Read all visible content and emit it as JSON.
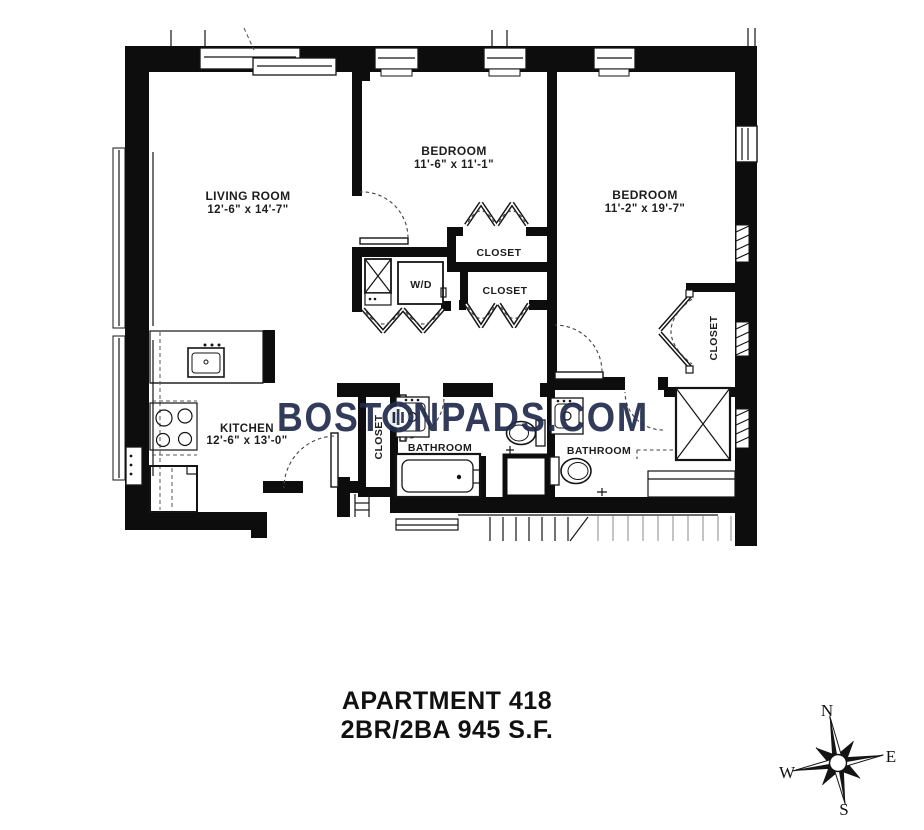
{
  "watermark": {
    "prefix": "BOST",
    "suffix": "NPADS.COM",
    "color": "#212b4c"
  },
  "rooms": {
    "living_room": {
      "name": "LIVING ROOM",
      "dims": "12'-6\" x 14'-7\""
    },
    "bedroom_1": {
      "name": "BEDROOM",
      "dims": "11'-6\" x 11'-1\""
    },
    "bedroom_2": {
      "name": "BEDROOM",
      "dims": "11'-2\" x 19'-7\""
    },
    "kitchen": {
      "name": "KITCHEN",
      "dims": "12'-6\" x 13'-0\""
    },
    "bathroom_1": {
      "name": "BATHROOM"
    },
    "bathroom_2": {
      "name": "BATHROOM"
    },
    "closet_bedroom_1_upper": {
      "name": "CLOSET"
    },
    "closet_bedroom_1_lower": {
      "name": "CLOSET"
    },
    "closet_entry": {
      "name": "CLOSET"
    },
    "closet_bedroom_2": {
      "name": "CLOSET"
    },
    "laundry": {
      "name": "W/D"
    }
  },
  "caption": {
    "line1": "APARTMENT 418",
    "line2": "2BR/2BA 945 S.F."
  },
  "compass": {
    "north": "N",
    "east": "E",
    "south": "S",
    "west": "W"
  }
}
